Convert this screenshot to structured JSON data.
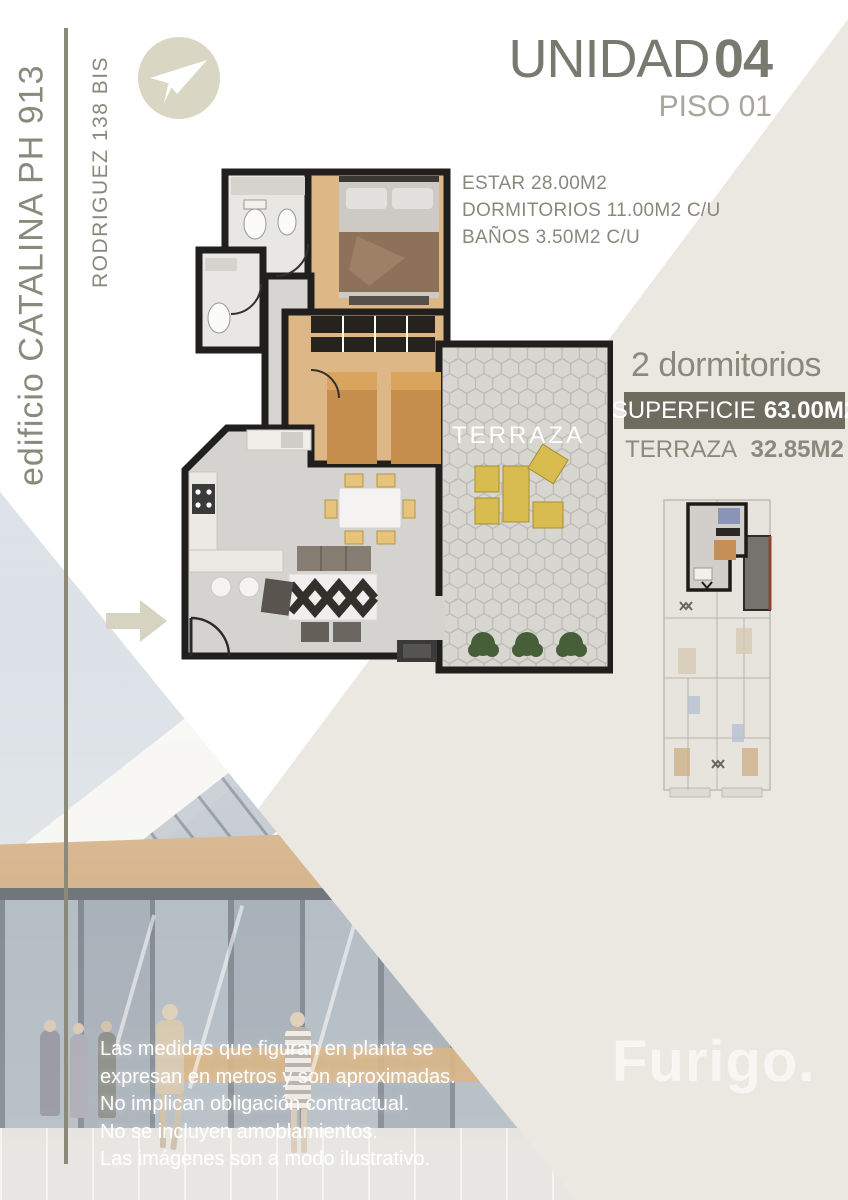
{
  "left_rail": {
    "building_name": "edificio CATALINA PH 913",
    "address": "RODRIGUEZ 138 BIS"
  },
  "header": {
    "unit_label": "UNIDAD",
    "unit_number": "04",
    "floor_label": "PISO 01"
  },
  "stats": {
    "lines": [
      "ESTAR 28.00M2",
      "DORMITORIOS 11.00M2 C/U",
      "BAÑOS 3.50M2 C/U"
    ]
  },
  "summary": {
    "bedrooms": "2 dormitorios",
    "superficie_label": "SUPERFICIE",
    "superficie_value": "63.00M2",
    "terraza_label": "TERRAZA",
    "terraza_value": "32.85M2"
  },
  "floorplan": {
    "terrace_label": "TERRAZA"
  },
  "disclaimer": {
    "lines": [
      "Las medidas que figuran en planta se",
      "expresan en metros y son aproximadas.",
      "No implican obligación contractual.",
      "No se incluyen amoblamientos.",
      "Las imágenes son a modo ilustrativo."
    ]
  },
  "watermark": "Furigo.",
  "icons": {
    "logo": "paper-plane-icon",
    "entrance": "right-arrow-icon"
  },
  "colors": {
    "accent_dark": "#6d6c5f",
    "beige_panel": "#eae8e1",
    "text_gray": "#8a887b",
    "logo_circle": "#dad6c4",
    "banner_text": "#ffffff"
  }
}
